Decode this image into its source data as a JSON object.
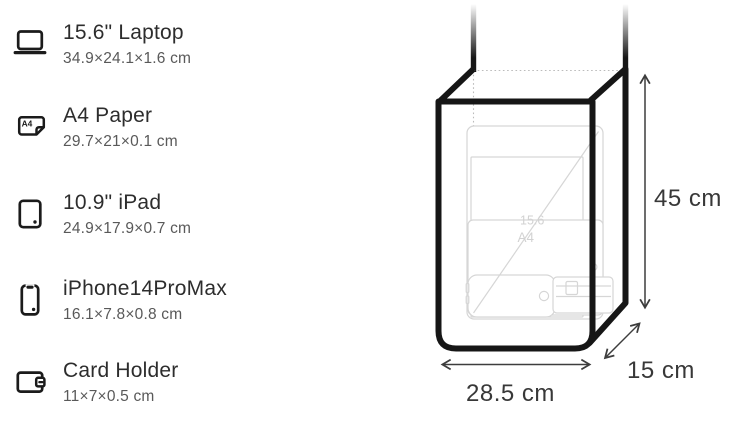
{
  "items": [
    {
      "icon": "laptop-icon",
      "name": "15.6\" Laptop",
      "dims": "34.9×24.1×1.6 cm"
    },
    {
      "icon": "a4-paper-icon",
      "name": "A4 Paper",
      "dims": "29.7×21×0.1 cm",
      "icon_label": "A4"
    },
    {
      "icon": "ipad-icon",
      "name": "10.9\" iPad",
      "dims": "24.9×17.9×0.7 cm"
    },
    {
      "icon": "iphone-icon",
      "name": "iPhone14ProMax",
      "dims": "16.1×7.8×0.8 cm"
    },
    {
      "icon": "card-holder-icon",
      "name": "Card Holder",
      "dims": "11×7×0.5 cm"
    }
  ],
  "diagram": {
    "height_label": "45 cm",
    "width_label": "28.5 cm",
    "depth_label": "15 cm",
    "ghost_labels": {
      "laptop": "15.6",
      "a4": "A4"
    },
    "colors": {
      "bag_outline": "#161616",
      "arrow": "#3d3d3d",
      "label": "#383838",
      "ghost_line": "#d6d6d6",
      "dotted_hidden_edge": "#bbbbbb"
    }
  }
}
